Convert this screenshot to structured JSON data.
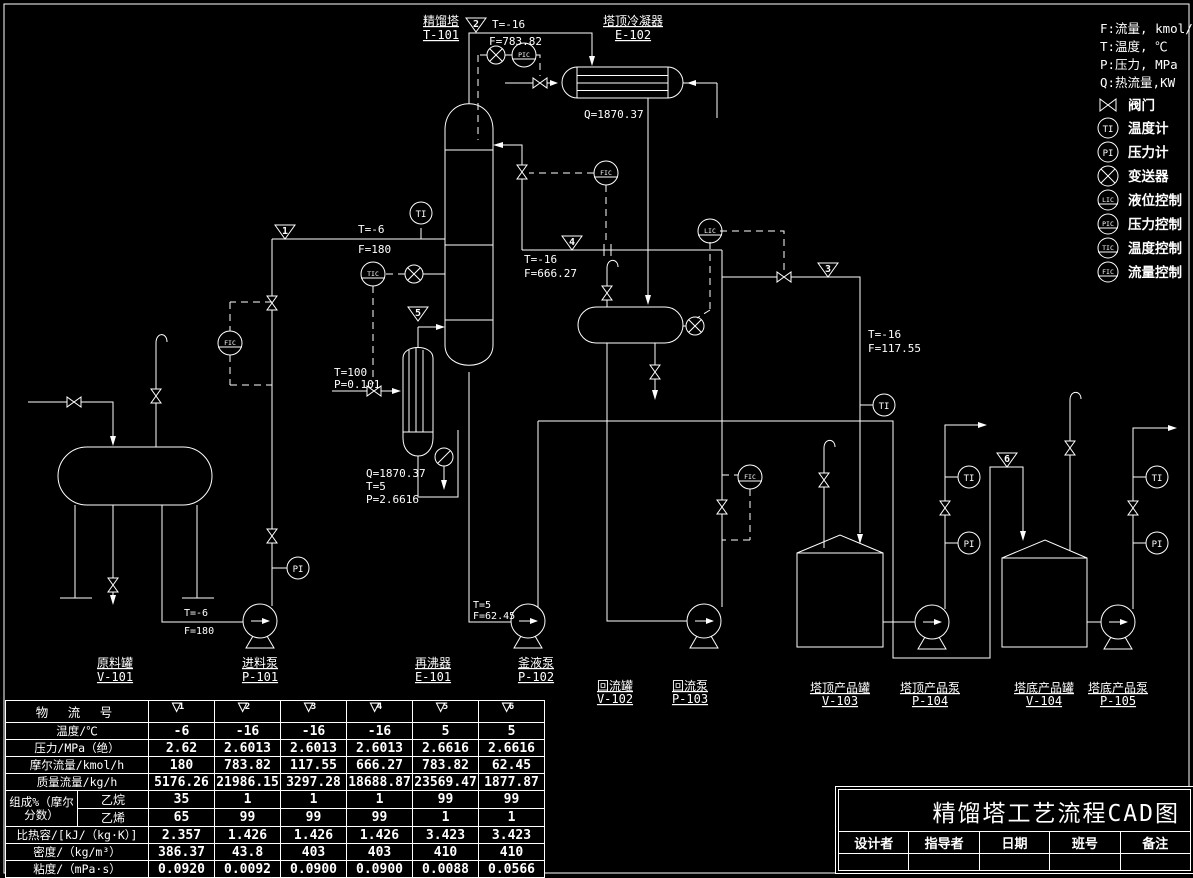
{
  "legend": {
    "units": [
      {
        "text": "F:流量, kmol/h"
      },
      {
        "text": "T:温度, ℃"
      },
      {
        "text": "P:压力, MPa"
      },
      {
        "text": "Q:热流量,KW"
      }
    ],
    "items": [
      {
        "symbol": "valve",
        "label": "阀门"
      },
      {
        "symbol": "TI",
        "label": "温度计"
      },
      {
        "symbol": "PI",
        "label": "压力计"
      },
      {
        "symbol": "transmitter",
        "label": "变送器"
      },
      {
        "symbol": "LIC",
        "label": "液位控制"
      },
      {
        "symbol": "PIC",
        "label": "压力控制"
      },
      {
        "symbol": "TIC",
        "label": "温度控制"
      },
      {
        "symbol": "FIC",
        "label": "流量控制"
      }
    ]
  },
  "instruments": {
    "ti": "TI",
    "pi": "PI",
    "lic": "LIC",
    "pic": "PIC",
    "tic": "TIC",
    "fic": "FIC"
  },
  "equipment": {
    "t101": {
      "name": "精馏塔",
      "tag": "T-101"
    },
    "e102": {
      "name": "塔顶冷凝器",
      "tag": "E-102"
    },
    "e101": {
      "name": "再沸器",
      "tag": "E-101"
    },
    "v101": {
      "name": "原料罐",
      "tag": "V-101"
    },
    "p101": {
      "name": "进料泵",
      "tag": "P-101"
    },
    "p102": {
      "name": "釜液泵",
      "tag": "P-102"
    },
    "v102": {
      "name": "回流罐",
      "tag": "V-102"
    },
    "p103": {
      "name": "回流泵",
      "tag": "P-103"
    },
    "v103": {
      "name": "塔顶产品罐",
      "tag": "V-103"
    },
    "p104": {
      "name": "塔顶产品泵",
      "tag": "P-104"
    },
    "v104": {
      "name": "塔底产品罐",
      "tag": "V-104"
    },
    "p105": {
      "name": "塔底产品泵",
      "tag": "P-105"
    }
  },
  "annotations": {
    "feed_t": "T=-6",
    "feed_f": "F=180",
    "ovhd_t": "T=-16",
    "ovhd_f": "F=783.82",
    "condenser_q": "Q=1870.37",
    "reflux_t": "T=-16",
    "reflux_f": "F=666.27",
    "dist_t": "T=-16",
    "dist_f": "F=117.55",
    "steam_t": "T=100",
    "steam_p": "P=0.101",
    "reboiler_q": "Q=1870.37",
    "reboiler_t": "T=5",
    "reboiler_p": "P=2.6616",
    "bottoms_t": "T=5",
    "bottoms_f": "F=62.45"
  },
  "streams": [
    "1",
    "2",
    "3",
    "4",
    "5",
    "6"
  ],
  "table": {
    "header_label": "物 流 号",
    "composition_label": "组成%（摩尔分数）",
    "rows": [
      {
        "label": "温度/℃",
        "values": [
          "-6",
          "-16",
          "-16",
          "-16",
          "5",
          "5"
        ]
      },
      {
        "label": "压力/MPa（绝）",
        "values": [
          "2.62",
          "2.6013",
          "2.6013",
          "2.6013",
          "2.6616",
          "2.6616"
        ]
      },
      {
        "label": "摩尔流量/kmol/h",
        "values": [
          "180",
          "783.82",
          "117.55",
          "666.27",
          "783.82",
          "62.45"
        ]
      },
      {
        "label": "质量流量/kg/h",
        "values": [
          "5176.26",
          "21986.15",
          "3297.28",
          "18688.87",
          "23569.47",
          "1877.87"
        ]
      },
      {
        "label": "乙烷",
        "values": [
          "35",
          "1",
          "1",
          "1",
          "99",
          "99"
        ]
      },
      {
        "label": "乙烯",
        "values": [
          "65",
          "99",
          "99",
          "99",
          "1",
          "1"
        ]
      },
      {
        "label": "比热容/[kJ/（kg·K）]",
        "values": [
          "2.357",
          "1.426",
          "1.426",
          "1.426",
          "3.423",
          "3.423"
        ]
      },
      {
        "label": "密度/（kg/m³）",
        "values": [
          "386.37",
          "43.8",
          "403",
          "403",
          "410",
          "410"
        ]
      },
      {
        "label": "粘度/（mPa·s）",
        "values": [
          "0.0920",
          "0.0092",
          "0.0900",
          "0.0900",
          "0.0088",
          "0.0566"
        ]
      }
    ]
  },
  "titleblock": {
    "title": "精馏塔工艺流程CAD图",
    "fields": [
      "设计者",
      "指导者",
      "日期",
      "班号",
      "备注"
    ]
  }
}
